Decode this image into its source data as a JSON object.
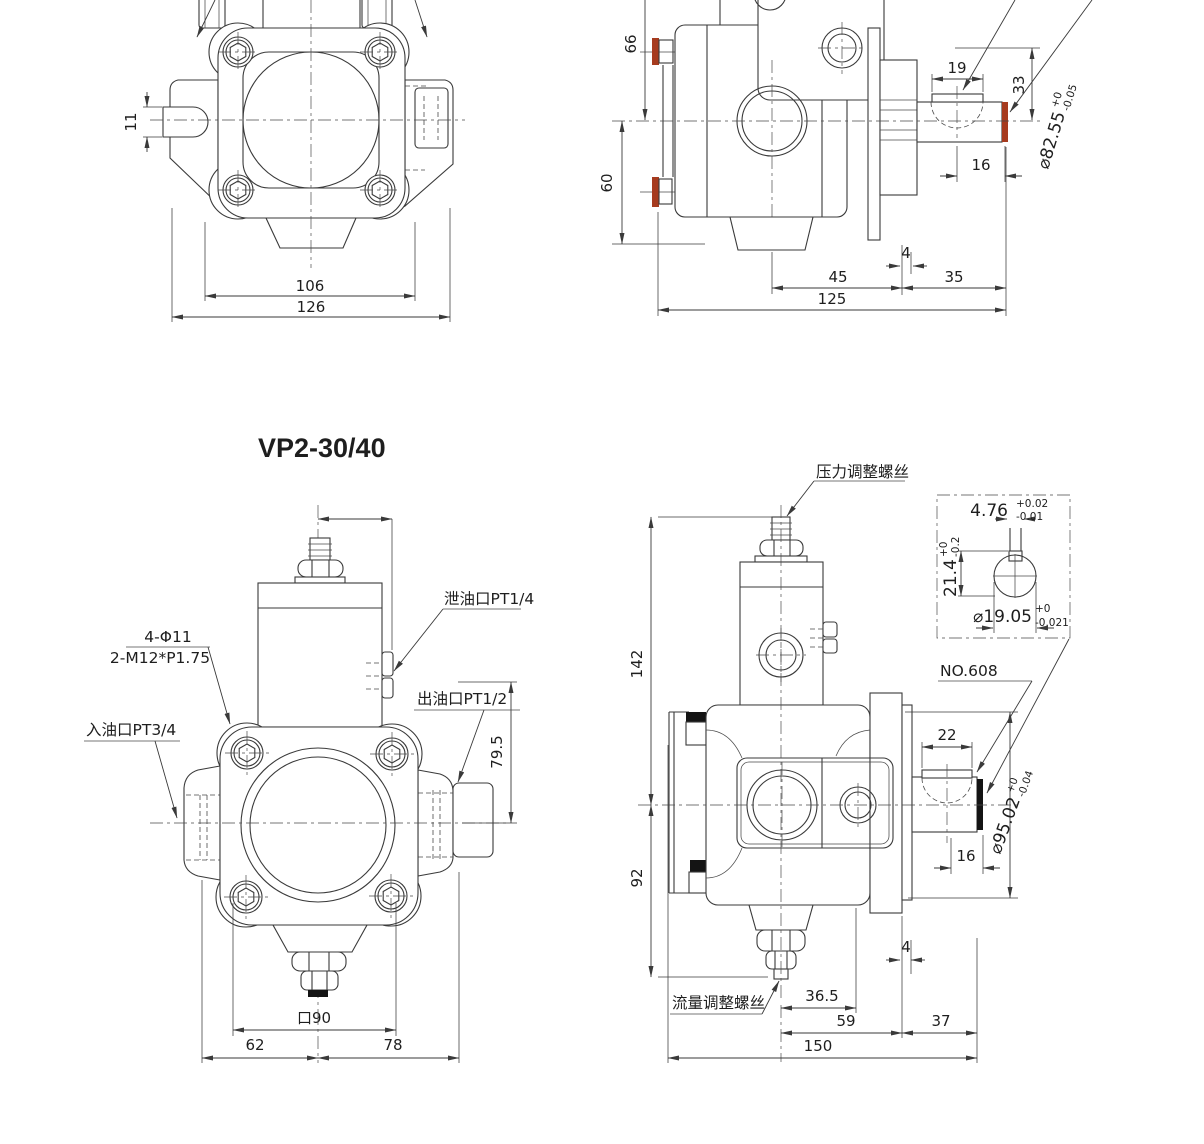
{
  "title": "VP2-30/40",
  "colors": {
    "line": "#3a3a3a",
    "seal_red": "#a63b1f",
    "mark_black": "#141414"
  },
  "views": {
    "front_top": {
      "dims": {
        "d11": "11",
        "d106": "106",
        "d126": "126"
      }
    },
    "side_top": {
      "dims": {
        "d66": "66",
        "d60": "60",
        "d19": "19",
        "d33": "33",
        "d16": "16",
        "d4": "4",
        "d45": "45",
        "d35": "35",
        "d125": "125"
      },
      "shaft": {
        "dia": "⌀82.55",
        "tol_top": "+0",
        "tol_bot": "-0.05"
      }
    },
    "front_bottom": {
      "labels": {
        "drain": "泄油口PT1/4",
        "holes": "4-Φ11",
        "thread": "2-M12*P1.75",
        "inlet": "入油口PT3/4",
        "outlet": "出油口PT1/2"
      },
      "dims": {
        "d79_5": "79.5",
        "d90": "口90",
        "d62": "62",
        "d78": "78"
      }
    },
    "side_bottom": {
      "labels": {
        "pressure": "压力调整螺丝",
        "flow": "流量调整螺丝",
        "bearing": "NO.608"
      },
      "dims": {
        "d142": "142",
        "d92": "92",
        "d22": "22",
        "d16": "16",
        "d4": "4",
        "d36_5": "36.5",
        "d59": "59",
        "d37": "37",
        "d150": "150"
      },
      "shaft": {
        "dia": "⌀95.02",
        "tol_top": "+0",
        "tol_bot": "-0.04"
      },
      "detail": {
        "key_w": "4.76",
        "key_w_tol_top": "+0.02",
        "key_w_tol_bot": "-0.01",
        "key_h": "21.4",
        "key_h_tol_top": "+0",
        "key_h_tol_bot": "-0.2",
        "dia": "⌀19.05",
        "dia_tol_top": "+0",
        "dia_tol_bot": "-0.021"
      }
    }
  }
}
